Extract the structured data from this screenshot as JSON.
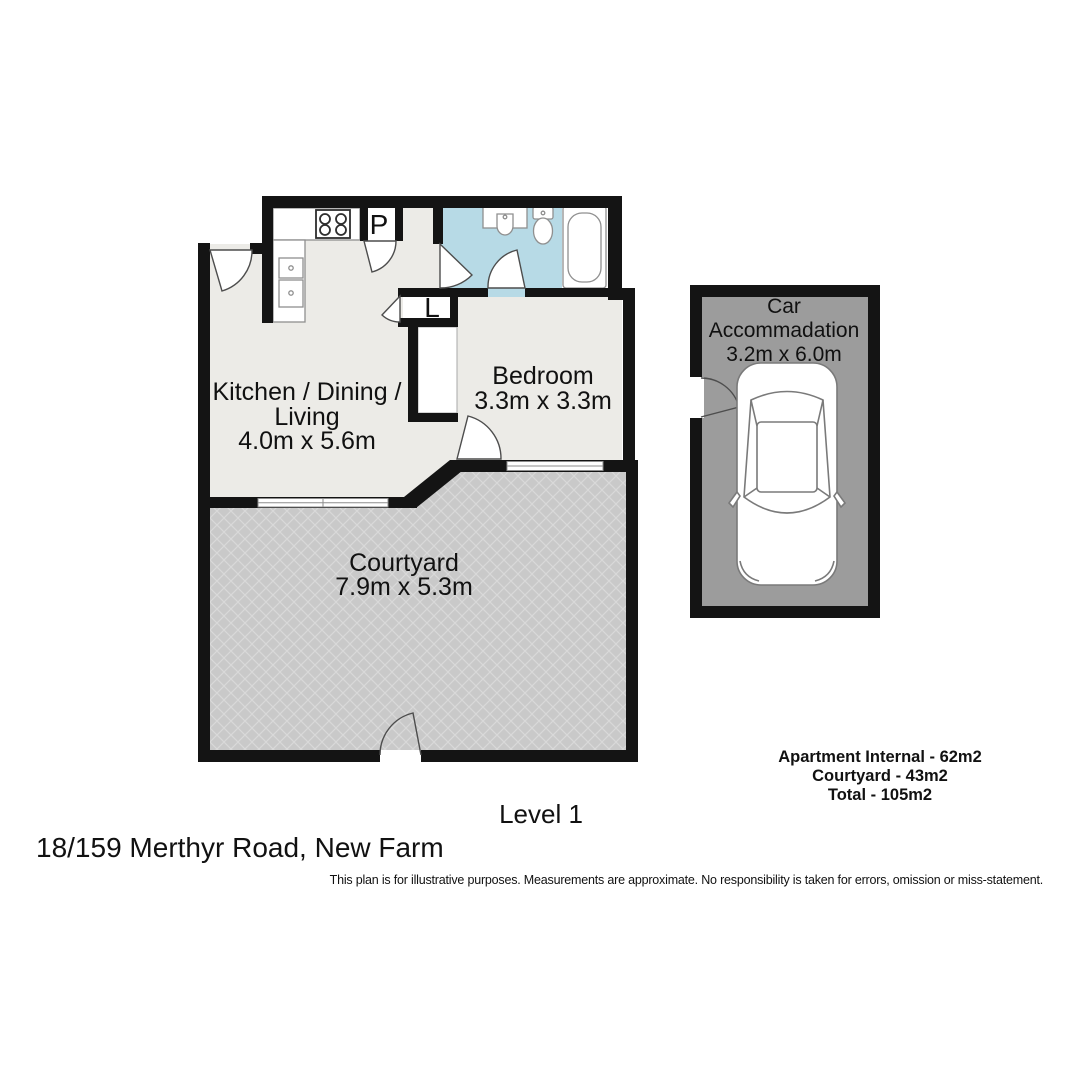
{
  "plan": {
    "level_label": "Level 1",
    "address": "18/159 Merthyr Road, New Farm",
    "disclaimer": "This plan is for illustrative purposes. Measurements are approximate. No responsibility is taken for errors, omission or miss-statement.",
    "area_summary": {
      "apartment_internal": "Apartment Internal - 62m2",
      "courtyard": "Courtyard - 43m2",
      "total": "Total - 105m2"
    },
    "rooms": {
      "living": {
        "label_line1": "Kitchen / Dining /",
        "label_line2": "Living",
        "dims": "4.0m x 5.6m"
      },
      "bedroom": {
        "label": "Bedroom",
        "dims": "3.3m x 3.3m"
      },
      "courtyard": {
        "label": "Courtyard",
        "dims": "7.9m x 5.3m"
      },
      "garage": {
        "label_line1": "Car",
        "label_line2": "Accommadation",
        "dims": "3.2m x 6.0m"
      },
      "pantry": {
        "label": "P"
      },
      "linen": {
        "label": "L"
      }
    },
    "colors": {
      "wall": "#141414",
      "floor": "#ecebe7",
      "bathroom": "#b7dae6",
      "courtyard": "#c9c9c9",
      "courtyard_line": "#d9d9d9",
      "garage": "#9c9c9c",
      "fixture_stroke": "#8f8f8f",
      "door_stroke": "#4d4d4d",
      "text": "#111111"
    }
  }
}
